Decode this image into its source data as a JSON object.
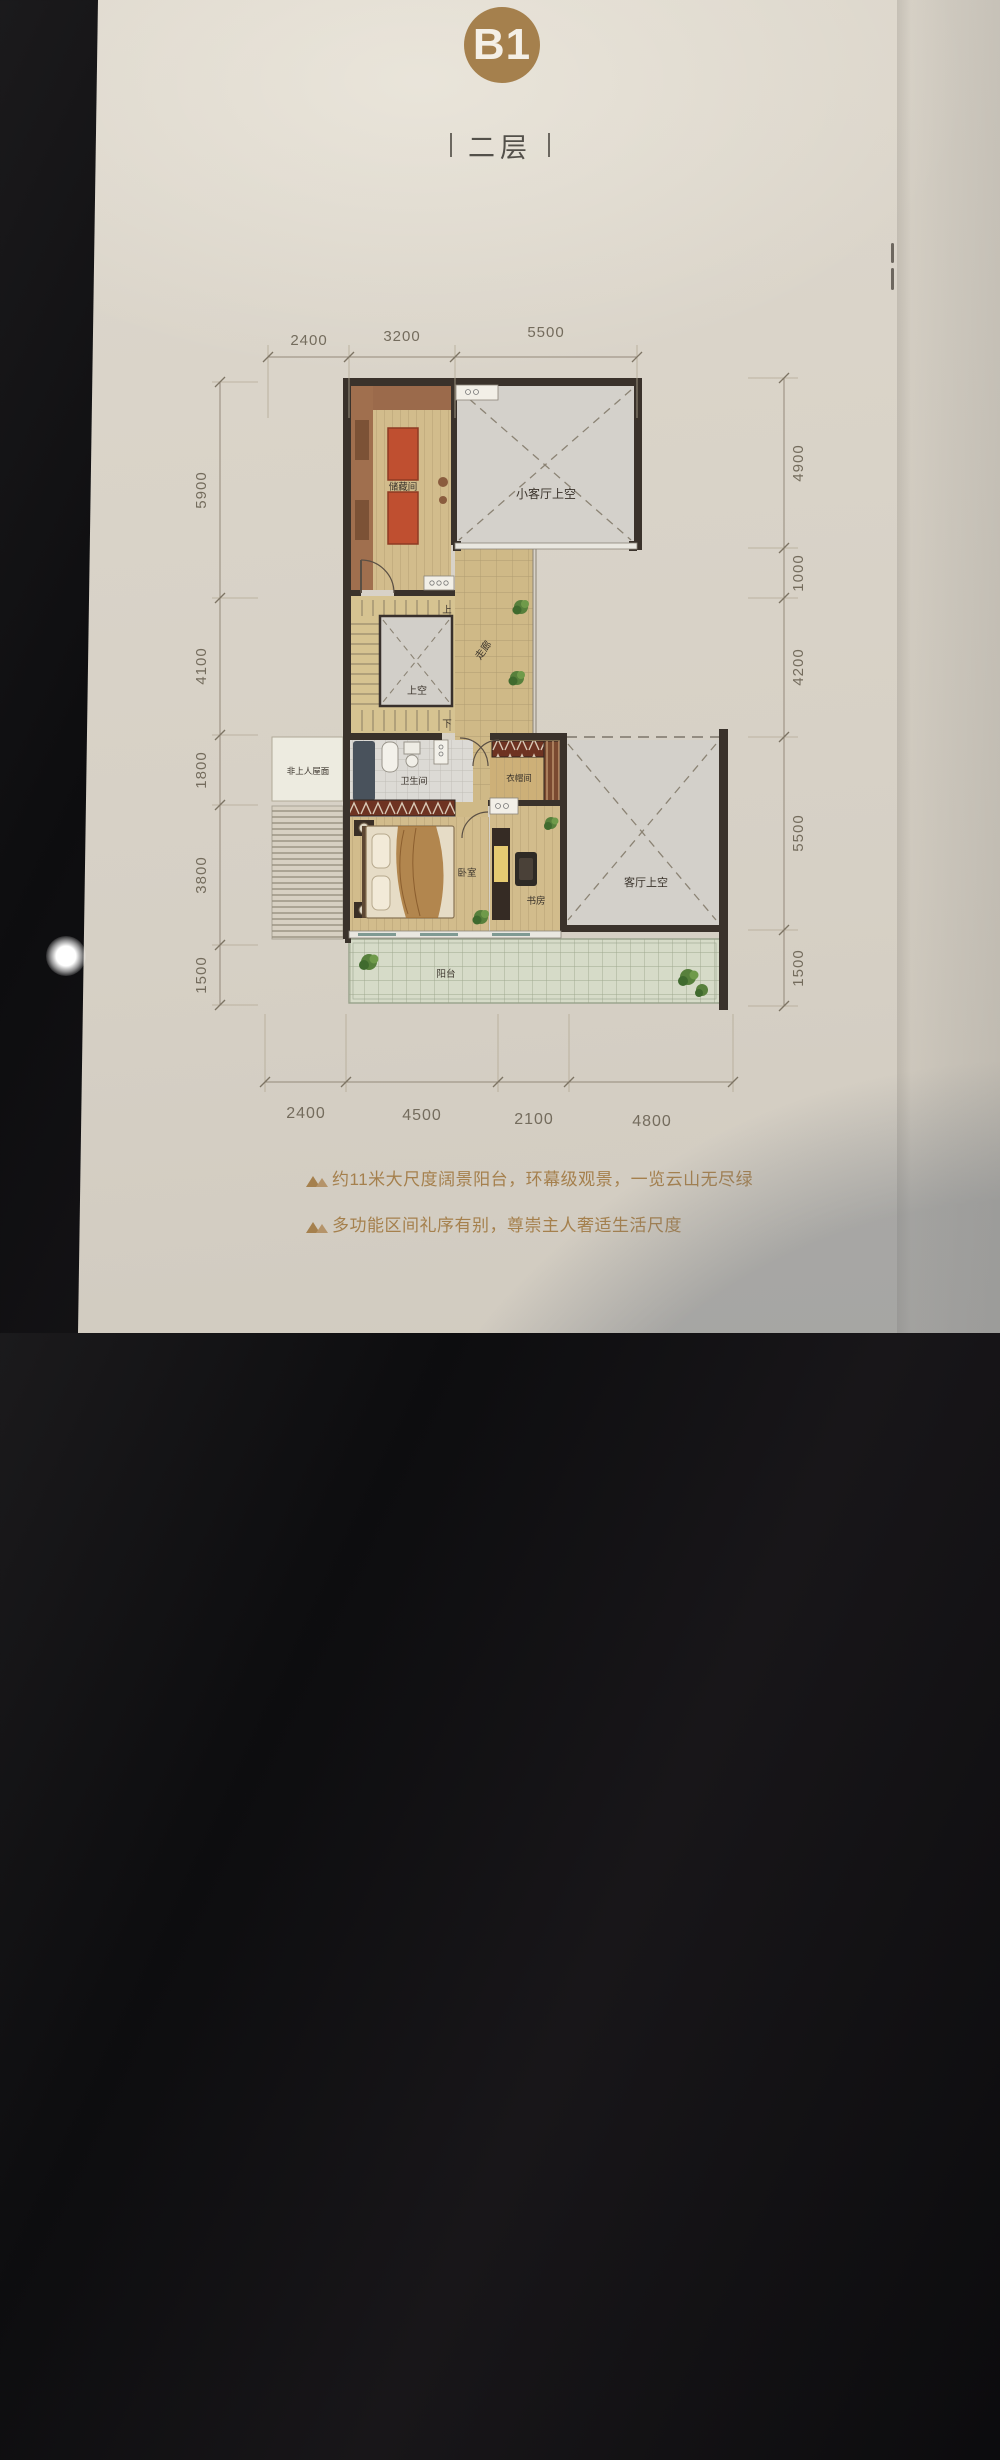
{
  "header": {
    "unit": "B1",
    "floor": "二层"
  },
  "plan": {
    "rooms": {
      "storage": "储藏间",
      "small_living_void": "小客厅上空",
      "corridor": "走廊",
      "up": "上",
      "down": "下",
      "stair_void": "上空",
      "roof": "非上人屋面",
      "bathroom": "卫生间",
      "cloakroom": "衣帽间",
      "bedroom": "卧室",
      "study": "书房",
      "living_void": "客厅上空",
      "balcony": "阳台"
    },
    "dimensions": {
      "top": [
        "2400",
        "3200",
        "5500"
      ],
      "bottom": [
        "2400",
        "4500",
        "2100",
        "4800"
      ],
      "left": [
        "5900",
        "4100",
        "1800",
        "3800",
        "1500"
      ],
      "right": [
        "4900",
        "1000",
        "4200",
        "5500",
        "1500"
      ]
    }
  },
  "features": [
    "约11米大尺度阔景阳台，环幕级观景，一览云山无尽绿",
    "多功能区间礼序有别，尊崇主人奢适生活尺度"
  ],
  "colors": {
    "accent_gold": "#a5804d",
    "paper": "#d8d2c7",
    "wall_dark": "#3a322b",
    "floor_tan": "#d2bc8c",
    "void_gray": "#d3d0ca",
    "rug_red": "#bf4f30",
    "balcony_green": "#d6dbc8",
    "dim_text": "#746c5d",
    "feature_text": "#a5804d"
  }
}
